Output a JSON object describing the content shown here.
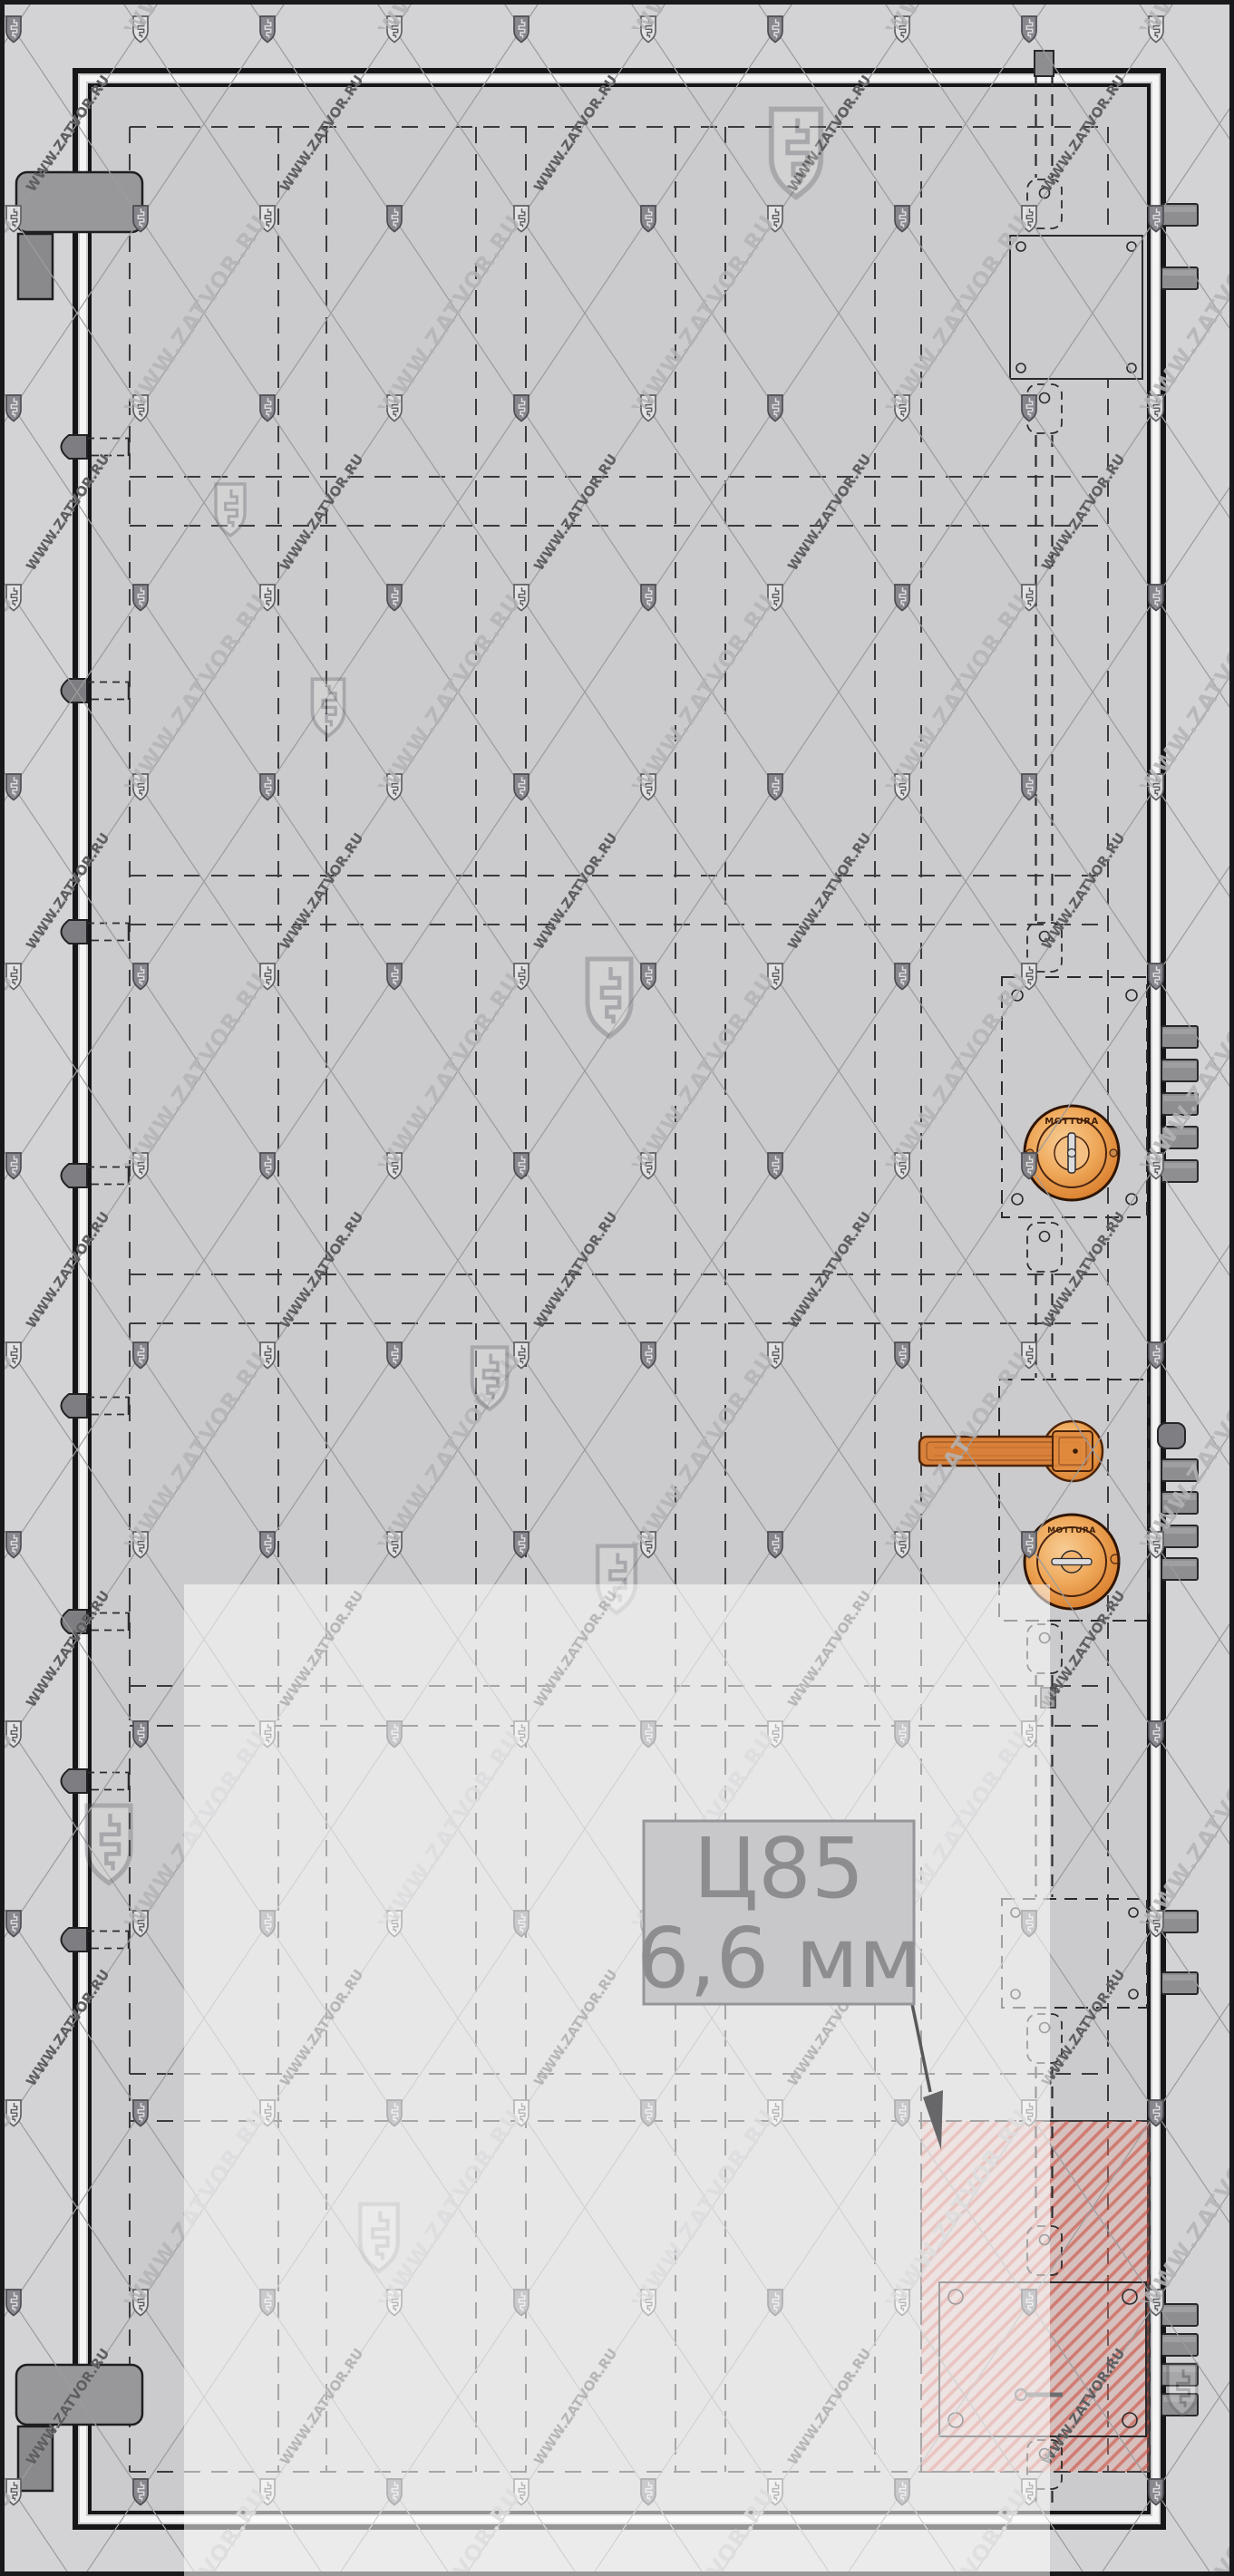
{
  "callout": {
    "line1": "Ц85",
    "line2": "6,6 мм"
  },
  "watermark": {
    "text": "WWW.ZATVOR.RU",
    "icon": "shield-key-icon"
  },
  "locks": {
    "upper_brand": "MOTTURA",
    "lower_brand": "MOTTURA"
  },
  "colors": {
    "wall": "#d3d3d5",
    "door": "#cbcbcd",
    "outline": "#19191b",
    "hardware_gray": "#8e8e91",
    "hardware_orange": "#d9813a",
    "hatch_red": "#cc4437",
    "callout_text": "#8d8d8f",
    "watermark_line": "#9c9c9e",
    "overlay_white": "#ffffff"
  }
}
